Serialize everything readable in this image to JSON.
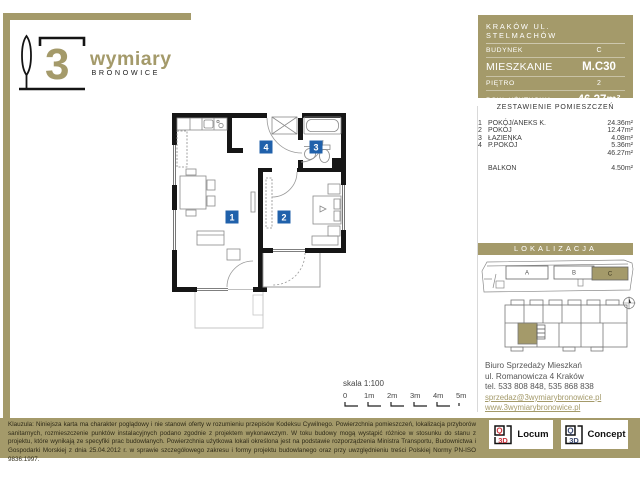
{
  "brand": {
    "number": "3",
    "name": "wymiary",
    "sub": "BRONOWICE"
  },
  "header": {
    "location": "KRAKÓW UL. STELMACHÓW",
    "rows": [
      {
        "label": "BUDYNEK",
        "value": "C"
      },
      {
        "label": "MIESZKANIE",
        "value": "M.C30"
      },
      {
        "label": "PIĘTRO",
        "value": "2"
      },
      {
        "label": "POW. UŻYTKOWA",
        "value": "46.27m²"
      }
    ]
  },
  "rooms": {
    "title": "ZESTAWIENIE POMIESZCZEŃ",
    "items": [
      {
        "no": "1",
        "name": "POKÓJ/ANEKS K.",
        "area": "24.36m²"
      },
      {
        "no": "2",
        "name": "POKÓJ",
        "area": "12.47m²"
      },
      {
        "no": "3",
        "name": "ŁAZIENKA",
        "area": "4.08m²"
      },
      {
        "no": "4",
        "name": "P.POKÓJ",
        "area": "5.36m²"
      }
    ],
    "total": "46.27m²",
    "balcony_label": "BALKON",
    "balcony_area": "4.50m²"
  },
  "plan": {
    "markers": [
      "1",
      "2",
      "3",
      "4"
    ],
    "scale_label": "skala 1:100",
    "scale_ticks": [
      "0",
      "1m",
      "2m",
      "3m",
      "4m",
      "5m"
    ]
  },
  "lokalizacja": {
    "title": "LOKALIZACJA",
    "buildings": [
      "A",
      "B",
      "C"
    ],
    "highlighted": "C"
  },
  "contact": {
    "line1": "Biuro Sprzedaży Mieszkań",
    "line2": "ul. Romanowicza 4 Kraków",
    "line3": "tel. 533 808 848, 535 868 838",
    "email": "sprzedaz@3wymiarybronowice.pl",
    "website": "www.3wymiarybronowice.pl"
  },
  "footer": {
    "disclaimer": "Klauzula: Niniejsza karta ma charakter poglądowy i nie stanowi oferty w rozumieniu przepisów Kodeksu Cywilnego. Powierzchnia pomieszczeń, lokalizacja przyborów sanitarnych, rozmieszczenie punktów instalacyjnych podano zgodnie z projektem wykonawczym. W toku budowy mogą wystąpić różnice w stosunku do stanu z projektu, które wynikają ze specyfiki prac budowlanych. Powierzchnia użytkowa lokali określona jest na podstawie rozporządzenia Ministra Transportu, Budownictwa i Gospodarki Morskiej z dnia 25.04.2012 r. w sprawie szczegółowego zakresu i formy projektu budowlanego oraz przy uwzględnieniu treści Polskiej Normy PN-ISO 9836:1997.",
    "logos": [
      {
        "mark_top": "Q",
        "mark_bottom": "3D",
        "name": "Locum",
        "color": "#c9353d"
      },
      {
        "mark_top": "Q",
        "mark_bottom": "3D",
        "name": "Concept",
        "color": "#3a4870"
      }
    ]
  },
  "colors": {
    "gold": "#a49a6a",
    "marker_blue": "#2061ab"
  }
}
